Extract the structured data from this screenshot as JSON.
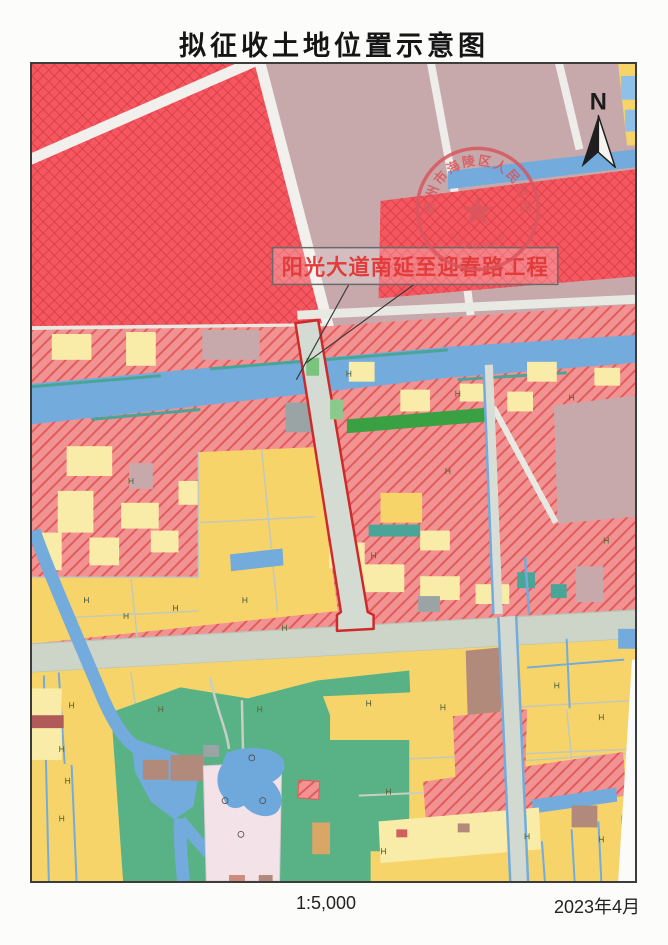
{
  "page": {
    "title": "拟征收土地位置示意图",
    "footer": {
      "scale": "1:5,000",
      "date": "2023年4月"
    }
  },
  "map": {
    "north_label": "N",
    "project_label": "阳光大道南延至迎春路工程",
    "stamp": {
      "ring_text": "泰州市海陵区人民政府",
      "bottom_text": "征收土地专用章"
    },
    "colors": {
      "expropriation_hatch_red": "#f4575f",
      "village_hatch_salmon": "#f29393",
      "farmland_yellow": "#f6d46a",
      "pale_parcel_yellow": "#f8eca8",
      "built_up_mauve": "#c7a9ab",
      "water_blue": "#72abdc",
      "greenland_green": "#58b286",
      "road_gray": "#ccd5c8",
      "project_boundary_red": "#cf2a2a",
      "stamp_red": "#d9565e"
    }
  }
}
